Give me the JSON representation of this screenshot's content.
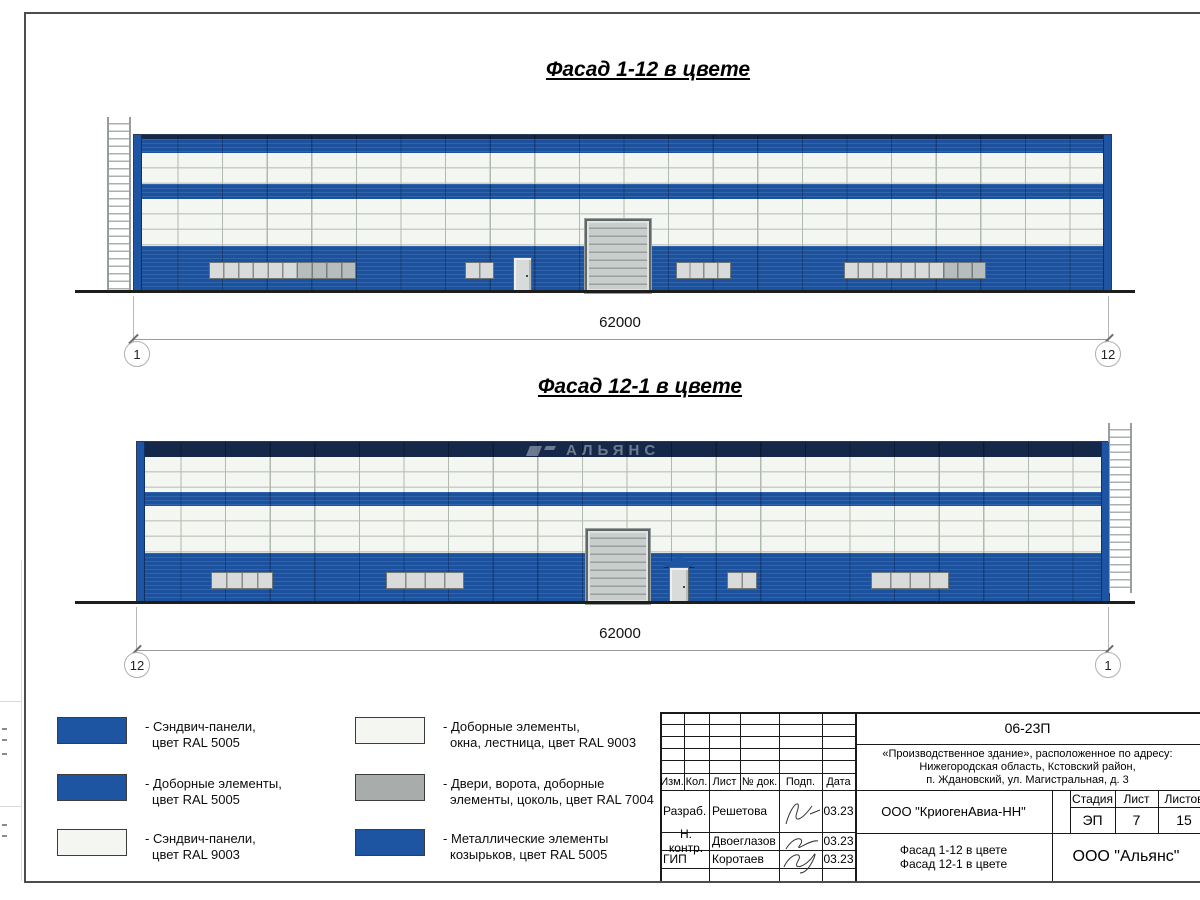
{
  "sheet": {
    "facade1": {
      "title": "Фасад 1-12 в цвете",
      "dim": "62000",
      "axis_left": "1",
      "axis_right": "12"
    },
    "facade2": {
      "title": "Фасад 12-1 в цвете",
      "dim": "62000",
      "axis_left": "12",
      "axis_right": "1"
    },
    "watermark": "АЛЬЯНС"
  },
  "legend": {
    "items": [
      {
        "color": "#1d55a3",
        "line1": "- Сэндвич-панели,",
        "line2": "цвет RAL 5005"
      },
      {
        "color": "#1d55a3",
        "line1": "- Доборные элементы,",
        "line2": "цвет RAL 5005"
      },
      {
        "color": "#f4f6f2",
        "line1": "- Сэндвич-панели,",
        "line2": "цвет RAL 9003"
      },
      {
        "color": "#f4f6f2",
        "line1": "- Доборные элементы,",
        "line2": "окна, лестница, цвет RAL 9003"
      },
      {
        "color": "#a8acab",
        "line1": "- Двери, ворота, доборные",
        "line2": "элементы, цоколь, цвет RAL 7004"
      },
      {
        "color": "#1d55a3",
        "line1": "- Металлические элементы",
        "line2": "козырьков, цвет RAL 5005"
      }
    ]
  },
  "title_block": {
    "doc_number": "06-23П",
    "project_line1": "«Производственное здание», расположенное по адресу:",
    "project_line2": "Нижегородская область, Кстовский район,",
    "project_line3": "п. Ждановский, ул. Магистральная, д. 3",
    "col_izm": "Изм.",
    "col_kol": "Кол.",
    "col_list": "Лист",
    "col_doc": "№ док.",
    "col_podp": "Подп.",
    "col_data": "Дата",
    "row1_role": "Разраб.",
    "row1_name": "Решетова",
    "row1_date": "03.23",
    "row2_role": "Н. контр.",
    "row2_name": "Двоеглазов",
    "row2_date": "03.23",
    "row3_role": "ГИП",
    "row3_name": "Коротаев",
    "row3_date": "03.23",
    "company": "ООО \"КриогенАвиа-НН\"",
    "sheet_title1": "Фасад 1-12 в цвете",
    "sheet_title2": "Фасад 12-1 в цвете",
    "stage_h": "Стадия",
    "list_h": "Лист",
    "listov_h": "Листов",
    "stage_v": "ЭП",
    "list_v": "7",
    "listov_v": "15",
    "org": "ООО \"Альянс\""
  },
  "colors": {
    "blue": "#1d55a3",
    "navy": "#16284a",
    "panel_white": "#f3f6f1",
    "gray_ral7004": "#a8acab"
  }
}
